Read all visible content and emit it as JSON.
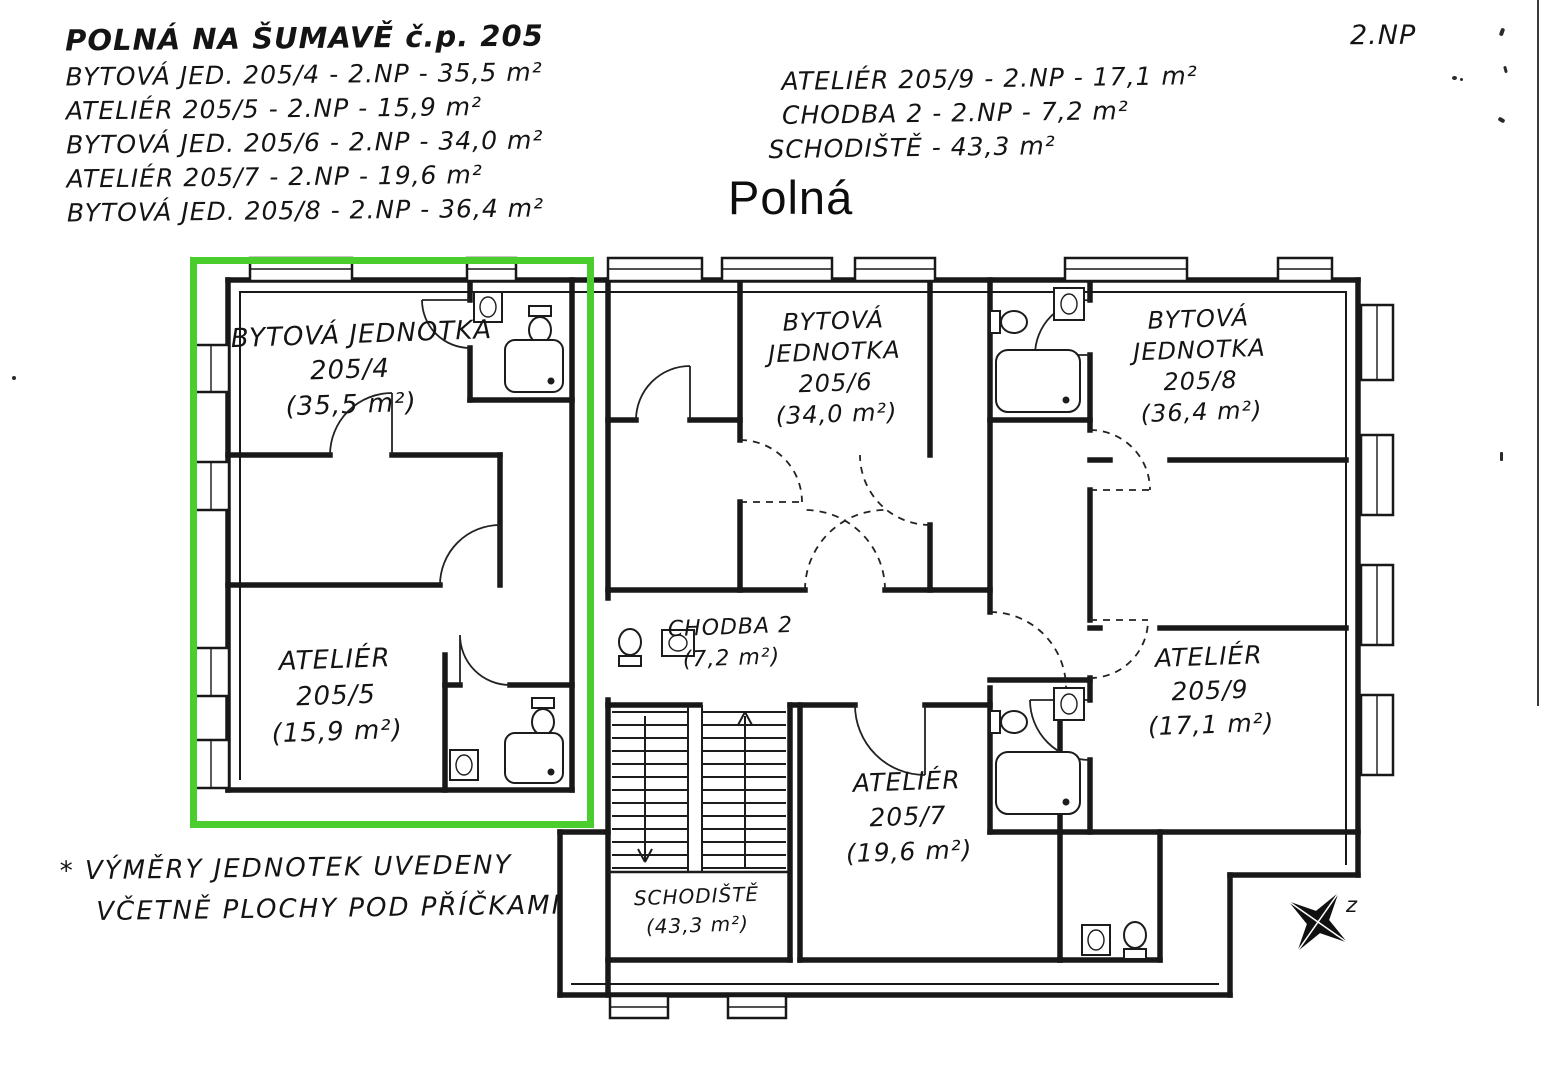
{
  "scan": {
    "corner_label": "2.NP",
    "street_title": "Polná",
    "compass_label": "z"
  },
  "legend_left": {
    "title": "POLNÁ NA ŠUMAVĚ č.p. 205",
    "lines": [
      "BYTOVÁ JED. 205/4 - 2.NP - 35,5 m²",
      "ATELIÉR 205/5 - 2.NP - 15,9 m²",
      "BYTOVÁ JED. 205/6 - 2.NP - 34,0 m²",
      "ATELIÉR 205/7 - 2.NP - 19,6 m²",
      "BYTOVÁ JED. 205/8 - 2.NP - 36,4 m²"
    ]
  },
  "legend_right": {
    "lines": [
      "ATELIÉR 205/9 - 2.NP - 17,1 m²",
      "CHODBA 2 - 2.NP - 7,2 m²",
      "SCHODIŠTĚ - 43,3 m²"
    ]
  },
  "rooms": {
    "unit205_4": {
      "lines": [
        "BYTOVÁ JEDNOTKA",
        "205/4",
        "(35,5 m²)"
      ]
    },
    "unit205_5": {
      "lines": [
        "ATELIÉR",
        "205/5",
        "(15,9 m²)"
      ]
    },
    "unit205_6": {
      "lines": [
        "BYTOVÁ",
        "JEDNOTKA",
        "205/6",
        "(34,0 m²)"
      ]
    },
    "chodba2": {
      "lines": [
        "CHODBA 2",
        "(7,2 m²)"
      ]
    },
    "schodiste": {
      "lines": [
        "SCHODIŠTĚ",
        "(43,3 m²)"
      ]
    },
    "unit205_7": {
      "lines": [
        "ATELIÉR",
        "205/7",
        "(19,6 m²)"
      ]
    },
    "unit205_8": {
      "lines": [
        "BYTOVÁ",
        "JEDNOTKA",
        "205/8",
        "(36,4 m²)"
      ]
    },
    "unit205_9": {
      "lines": [
        "ATELIÉR",
        "205/9",
        "(17,1 m²)"
      ]
    }
  },
  "footnote": {
    "lines": [
      "* VÝMĚRY JEDNOTEK UVEDENY",
      "VČETNĚ PLOCHY POD PŘÍČKAMI"
    ]
  },
  "highlight": {
    "color": "#4ccd2e"
  }
}
